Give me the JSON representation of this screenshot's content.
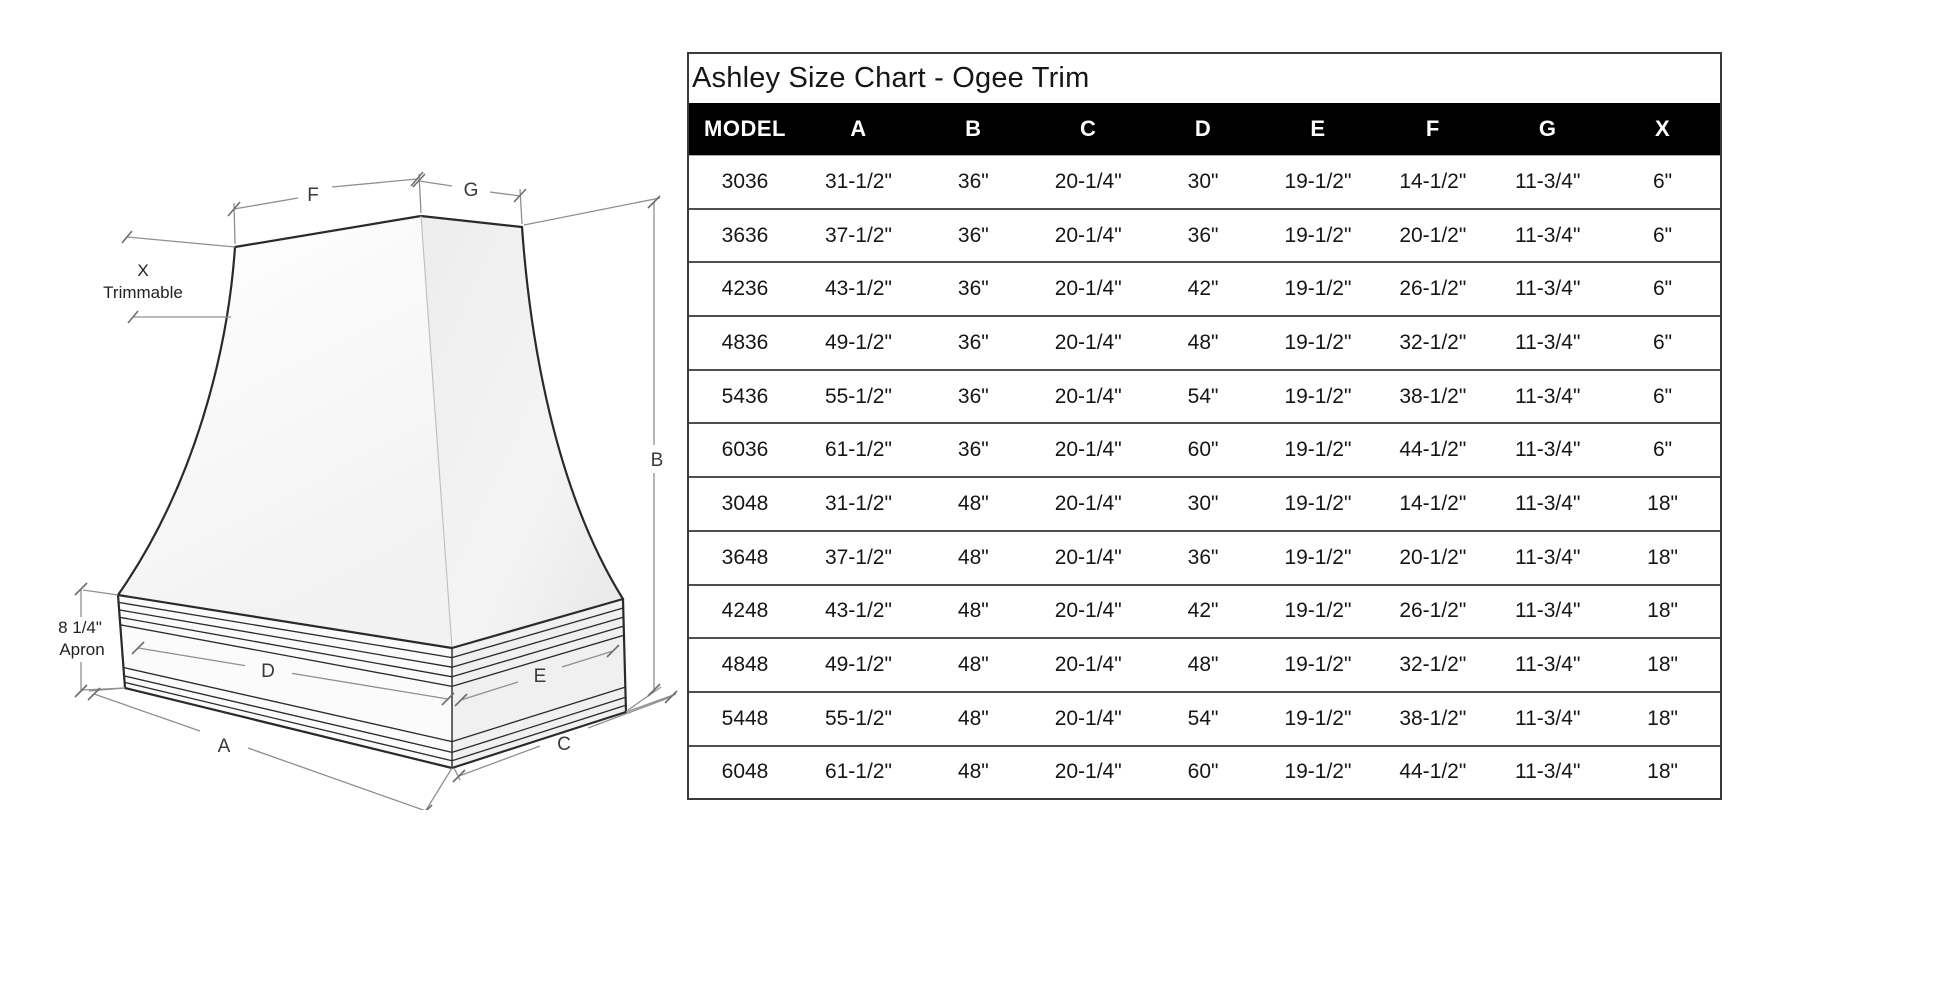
{
  "title": "Ashley Size Chart - Ogee Trim",
  "table": {
    "columns": [
      "MODEL",
      "A",
      "B",
      "C",
      "D",
      "E",
      "F",
      "G",
      "X"
    ],
    "rows": [
      [
        "3036",
        "31-1/2\"",
        "36\"",
        "20-1/4\"",
        "30\"",
        "19-1/2\"",
        "14-1/2\"",
        "11-3/4\"",
        "6\""
      ],
      [
        "3636",
        "37-1/2\"",
        "36\"",
        "20-1/4\"",
        "36\"",
        "19-1/2\"",
        "20-1/2\"",
        "11-3/4\"",
        "6\""
      ],
      [
        "4236",
        "43-1/2\"",
        "36\"",
        "20-1/4\"",
        "42\"",
        "19-1/2\"",
        "26-1/2\"",
        "11-3/4\"",
        "6\""
      ],
      [
        "4836",
        "49-1/2\"",
        "36\"",
        "20-1/4\"",
        "48\"",
        "19-1/2\"",
        "32-1/2\"",
        "11-3/4\"",
        "6\""
      ],
      [
        "5436",
        "55-1/2\"",
        "36\"",
        "20-1/4\"",
        "54\"",
        "19-1/2\"",
        "38-1/2\"",
        "11-3/4\"",
        "6\""
      ],
      [
        "6036",
        "61-1/2\"",
        "36\"",
        "20-1/4\"",
        "60\"",
        "19-1/2\"",
        "44-1/2\"",
        "11-3/4\"",
        "6\""
      ],
      [
        "3048",
        "31-1/2\"",
        "48\"",
        "20-1/4\"",
        "30\"",
        "19-1/2\"",
        "14-1/2\"",
        "11-3/4\"",
        "18\""
      ],
      [
        "3648",
        "37-1/2\"",
        "48\"",
        "20-1/4\"",
        "36\"",
        "19-1/2\"",
        "20-1/2\"",
        "11-3/4\"",
        "18\""
      ],
      [
        "4248",
        "43-1/2\"",
        "48\"",
        "20-1/4\"",
        "42\"",
        "19-1/2\"",
        "26-1/2\"",
        "11-3/4\"",
        "18\""
      ],
      [
        "4848",
        "49-1/2\"",
        "48\"",
        "20-1/4\"",
        "48\"",
        "19-1/2\"",
        "32-1/2\"",
        "11-3/4\"",
        "18\""
      ],
      [
        "5448",
        "55-1/2\"",
        "48\"",
        "20-1/4\"",
        "54\"",
        "19-1/2\"",
        "38-1/2\"",
        "11-3/4\"",
        "18\""
      ],
      [
        "6048",
        "61-1/2\"",
        "48\"",
        "20-1/4\"",
        "60\"",
        "19-1/2\"",
        "44-1/2\"",
        "11-3/4\"",
        "18\""
      ]
    ]
  },
  "diagram": {
    "labels": {
      "f": "F",
      "g": "G",
      "b": "B",
      "a": "A",
      "c": "C",
      "d": "D",
      "e": "E",
      "x_label": "X",
      "x_sub": "Trimmable",
      "apron_value": "8 1/4\"",
      "apron_word": "Apron"
    }
  },
  "colors": {
    "header_bg": "#000000",
    "header_text": "#ffffff",
    "row_divider": "#4f4f4f",
    "table_border": "#3a3a3a",
    "sketch_line": "#2a2a2a",
    "dimension_line": "#8f8f8f"
  }
}
